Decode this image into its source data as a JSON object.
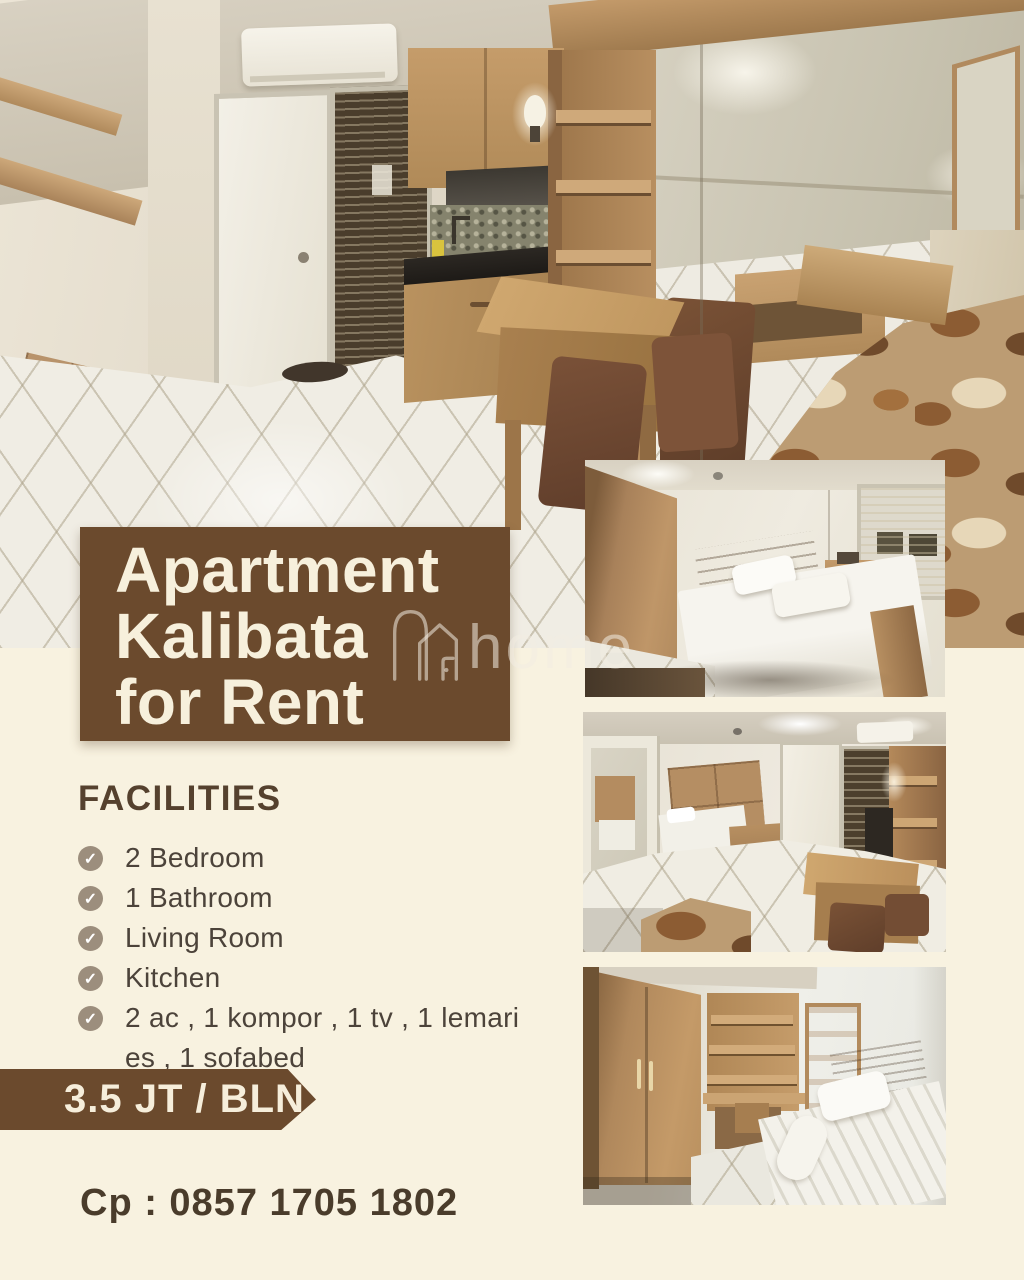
{
  "flyer": {
    "background_color": "#f8f2e0",
    "accent_brown": "#6b4a2d"
  },
  "title": {
    "line1": "Apartment",
    "line2": "Kalibata",
    "line3": "for Rent"
  },
  "watermark": {
    "text": "home"
  },
  "facilities": {
    "heading": "FACILITIES",
    "items": [
      "2 Bedroom",
      "1 Bathroom",
      "Living Room",
      "Kitchen",
      "2 ac , 1 kompor , 1 tv , 1 lemari\nes , 1 sofabed"
    ]
  },
  "price": {
    "label": "3.5 JT / BLN"
  },
  "contact": {
    "label": "Cp : 0857 1705 1802"
  },
  "photos": {
    "main": "kitchen-and-mirror-overview",
    "second": "main-bedroom-double-bed",
    "third": "living-area-with-door-and-shelves",
    "fourth": "second-bedroom-wardrobe-single-bed"
  }
}
